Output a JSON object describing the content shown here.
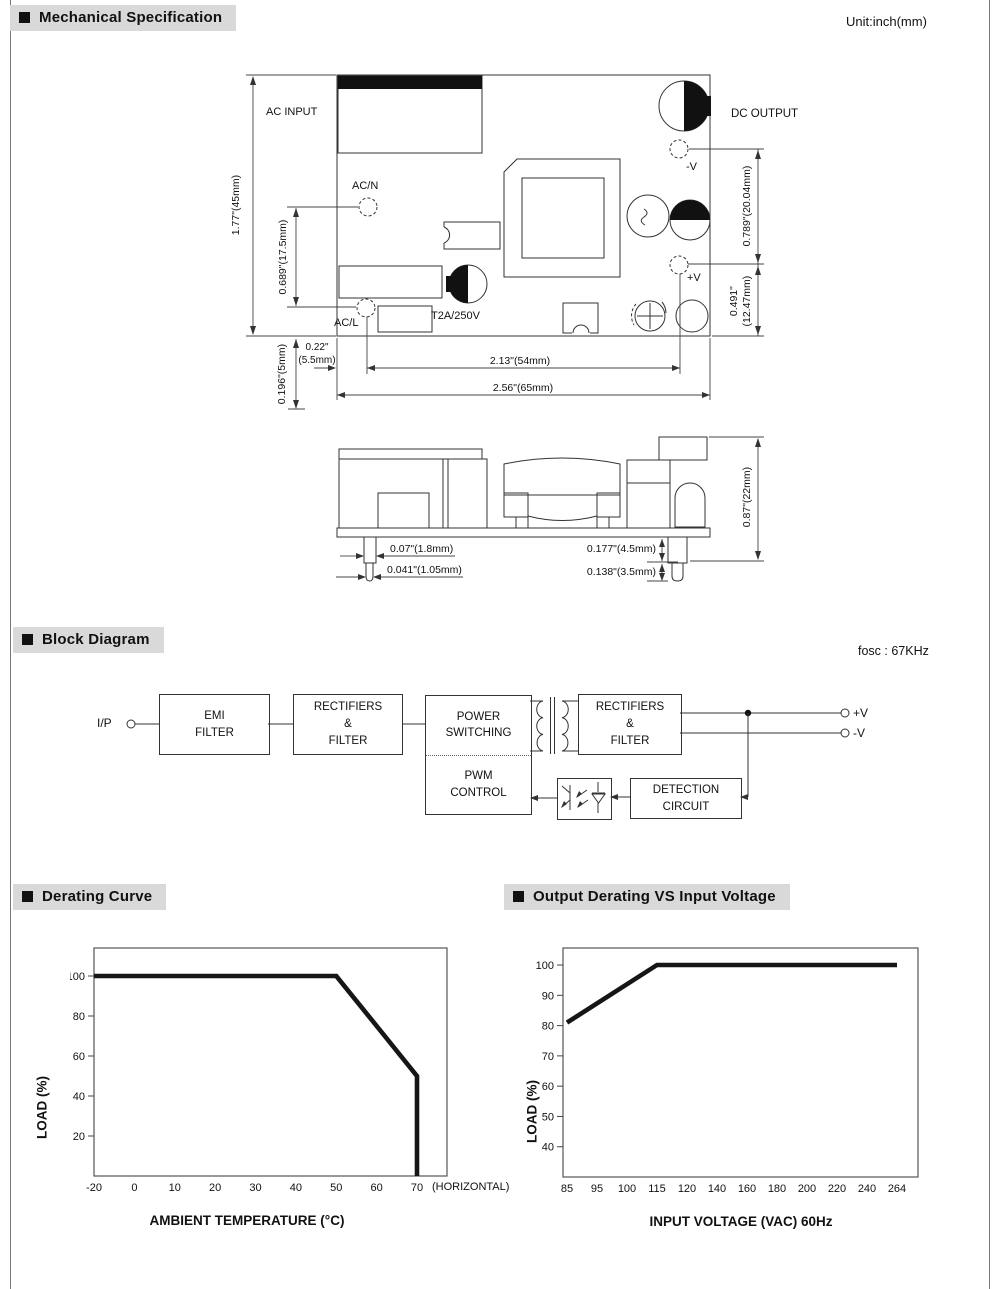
{
  "page": {
    "unit": "Unit:inch(mm)"
  },
  "headers": {
    "mechanical": "Mechanical Specification",
    "block": "Block Diagram",
    "derating": "Derating Curve",
    "output_derating": "Output Derating VS Input Voltage"
  },
  "mech": {
    "labels": {
      "ac_input": "AC INPUT",
      "ac_n": "AC/N",
      "ac_l": "AC/L",
      "fuse": "T2A/250V",
      "dc_output": "DC OUTPUT",
      "neg_v": "-V",
      "pos_v": "+V"
    },
    "dims": {
      "board_height": "1.77\"(45mm)",
      "ac_pin_span": "0.689\"(17.5mm)",
      "out_pin_span": "0.789\"(20.04mm)",
      "out_pin_lower": "0.491\"\n(12.47mm)",
      "below_board": "0.196\"(5mm)",
      "edge_to_pin": "0.22\"\n(5.5mm)",
      "pin_span_h": "2.13\"(54mm)",
      "board_width": "2.56\"(65mm)",
      "pin_width": "0.07\"(1.8mm)",
      "pin_tip_width": "0.041\"(1.05mm)",
      "pin_len_a": "0.177\"(4.5mm)",
      "pin_len_b": "0.138\"(3.5mm)",
      "side_height": "0.87\"(22mm)"
    }
  },
  "block": {
    "fosc": "fosc : 67KHz",
    "input": "I/P",
    "boxes": {
      "emi": "EMI\nFILTER",
      "rect1": "RECTIFIERS\n&\nFILTER",
      "power": "POWER\nSWITCHING",
      "pwm": "PWM\nCONTROL",
      "rect2": "RECTIFIERS\n&\nFILTER",
      "detection": "DETECTION\nCIRCUIT"
    },
    "out_pos": "+V",
    "out_neg": "-V"
  },
  "chart_data": [
    {
      "type": "line",
      "title": "Derating Curve",
      "xlabel": "AMBIENT TEMPERATURE (°C)",
      "ylabel": "LOAD (%)",
      "x_suffix_label": "(HORIZONTAL)",
      "xticks": [
        -20,
        0,
        10,
        20,
        30,
        40,
        50,
        60,
        70
      ],
      "yticks": [
        20,
        40,
        60,
        80,
        100
      ],
      "ylim": [
        0,
        114
      ],
      "legend": false,
      "grid": false,
      "points": [
        [
          -20,
          100
        ],
        [
          50,
          100
        ],
        [
          70,
          50
        ],
        [
          70,
          0
        ]
      ]
    },
    {
      "type": "line",
      "title": "Output Derating VS Input Voltage",
      "xlabel": "INPUT VOLTAGE (VAC) 60Hz",
      "ylabel": "LOAD (%)",
      "xticks": [
        85,
        95,
        100,
        115,
        120,
        140,
        160,
        180,
        200,
        220,
        240,
        264
      ],
      "yticks": [
        40,
        50,
        60,
        70,
        80,
        90,
        100
      ],
      "ylim": [
        30,
        106
      ],
      "legend": false,
      "grid": false,
      "points": [
        [
          85,
          81
        ],
        [
          115,
          100
        ],
        [
          264,
          100
        ]
      ]
    }
  ]
}
